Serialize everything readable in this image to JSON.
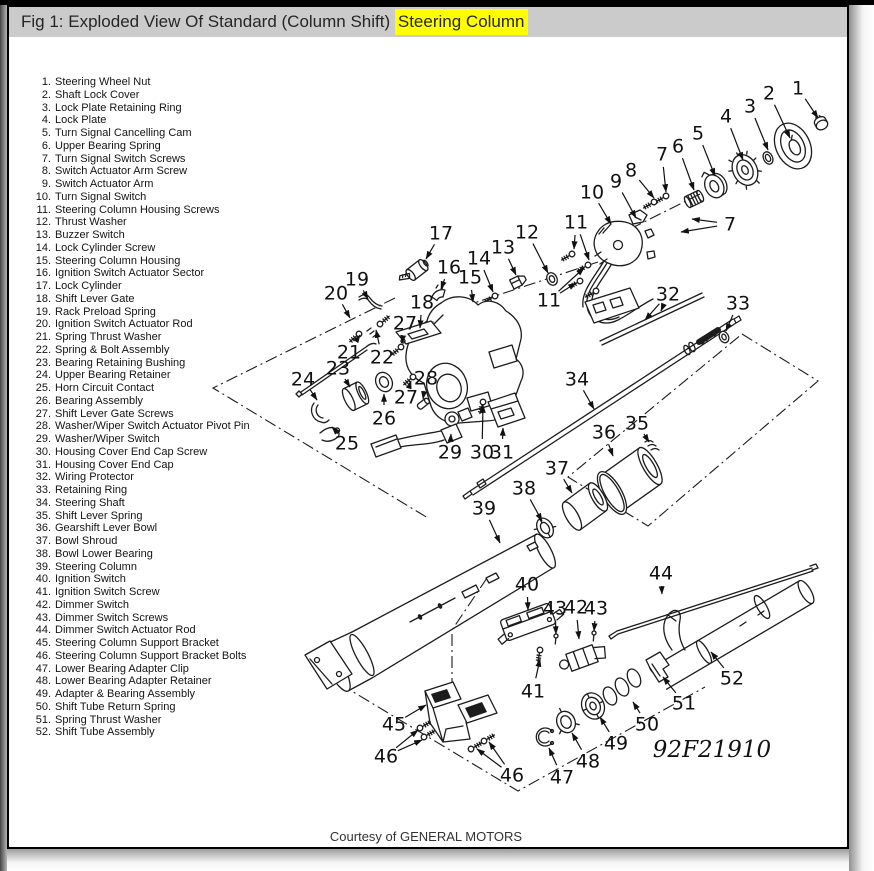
{
  "figure": {
    "title_prefix": "Fig 1: Exploded View Of Standard (Column Shift) ",
    "title_highlight": "Steering Column",
    "highlight_color": "#ffff00",
    "title_bar_bg": "#cbcbcb"
  },
  "footer": {
    "credit": "Courtesy of GENERAL MOTORS"
  },
  "parts_list": {
    "items": [
      {
        "num": "1",
        "name": "Steering Wheel Nut"
      },
      {
        "num": "2",
        "name": "Shaft Lock Cover"
      },
      {
        "num": "3",
        "name": "Lock Plate Retaining Ring"
      },
      {
        "num": "4",
        "name": "Lock Plate"
      },
      {
        "num": "5",
        "name": "Turn Signal Cancelling Cam"
      },
      {
        "num": "6",
        "name": "Upper Bearing Spring"
      },
      {
        "num": "7",
        "name": "Turn Signal Switch Screws"
      },
      {
        "num": "8",
        "name": "Switch Actuator Arm Screw"
      },
      {
        "num": "9",
        "name": "Switch Actuator Arm"
      },
      {
        "num": "10",
        "name": "Turn Signal Switch"
      },
      {
        "num": "11",
        "name": "Steering Column Housing Screws"
      },
      {
        "num": "12",
        "name": "Thrust Washer"
      },
      {
        "num": "13",
        "name": "Buzzer Switch"
      },
      {
        "num": "14",
        "name": "Lock Cylinder Screw"
      },
      {
        "num": "15",
        "name": "Steering Column Housing"
      },
      {
        "num": "16",
        "name": "Ignition Switch Actuator Sector"
      },
      {
        "num": "17",
        "name": "Lock Cylinder"
      },
      {
        "num": "18",
        "name": "Shift Lever Gate"
      },
      {
        "num": "19",
        "name": "Rack Preload Spring"
      },
      {
        "num": "20",
        "name": "Ignition Switch Actuator Rod"
      },
      {
        "num": "21",
        "name": "Spring Thrust Washer"
      },
      {
        "num": "22",
        "name": "Spring & Bolt Assembly"
      },
      {
        "num": "23",
        "name": "Bearing Retaining Bushing"
      },
      {
        "num": "24",
        "name": "Upper Bearing Retainer"
      },
      {
        "num": "25",
        "name": "Horn Circuit Contact"
      },
      {
        "num": "26",
        "name": "Bearing Assembly"
      },
      {
        "num": "27",
        "name": "Shift Lever Gate Screws"
      },
      {
        "num": "28",
        "name": "Washer/Wiper Switch Actuator Pivot Pin"
      },
      {
        "num": "29",
        "name": "Washer/Wiper Switch"
      },
      {
        "num": "30",
        "name": "Housing Cover End Cap Screw"
      },
      {
        "num": "31",
        "name": "Housing Cover End Cap"
      },
      {
        "num": "32",
        "name": "Wiring Protector"
      },
      {
        "num": "33",
        "name": "Retaining Ring"
      },
      {
        "num": "34",
        "name": "Steering Shaft"
      },
      {
        "num": "35",
        "name": "Shift Lever Spring"
      },
      {
        "num": "36",
        "name": "Gearshift Lever Bowl"
      },
      {
        "num": "37",
        "name": "Bowl Shroud"
      },
      {
        "num": "38",
        "name": "Bowl Lower Bearing"
      },
      {
        "num": "39",
        "name": "Steering Column"
      },
      {
        "num": "40",
        "name": "Ignition Switch"
      },
      {
        "num": "41",
        "name": "Ignition Switch Screw"
      },
      {
        "num": "42",
        "name": "Dimmer Switch"
      },
      {
        "num": "43",
        "name": "Dimmer Switch Screws"
      },
      {
        "num": "44",
        "name": "Dimmer Switch Actuator Rod"
      },
      {
        "num": "45",
        "name": "Steering Column Support Bracket"
      },
      {
        "num": "46",
        "name": "Steering Column Support Bracket Bolts"
      },
      {
        "num": "47",
        "name": "Lower Bearing Adapter Clip"
      },
      {
        "num": "48",
        "name": "Lower Bearing Adapter Retainer"
      },
      {
        "num": "49",
        "name": "Adapter & Bearing Assembly"
      },
      {
        "num": "50",
        "name": "Shift Tube Return Spring"
      },
      {
        "num": "51",
        "name": "Spring Thrust Washer"
      },
      {
        "num": "52",
        "name": "Shift Tube Assembly"
      }
    ]
  },
  "diagram": {
    "figure_code": "92F21910",
    "callouts": [
      {
        "label": "1",
        "x": 798,
        "y": 88,
        "tips": [
          [
            818,
            118
          ]
        ]
      },
      {
        "label": "2",
        "x": 769,
        "y": 93,
        "tips": [
          [
            790,
            138
          ]
        ]
      },
      {
        "label": "3",
        "x": 750,
        "y": 106,
        "tips": [
          [
            768,
            150
          ]
        ]
      },
      {
        "label": "4",
        "x": 726,
        "y": 116,
        "tips": [
          [
            743,
            160
          ]
        ]
      },
      {
        "label": "5",
        "x": 698,
        "y": 133,
        "tips": [
          [
            715,
            176
          ]
        ]
      },
      {
        "label": "6",
        "x": 678,
        "y": 146,
        "tips": [
          [
            694,
            190
          ]
        ]
      },
      {
        "label": "7",
        "x": 662,
        "y": 154,
        "tips": [
          [
            666,
            192
          ]
        ]
      },
      {
        "label": "8",
        "x": 631,
        "y": 170,
        "tips": [
          [
            654,
            198
          ]
        ]
      },
      {
        "label": "9",
        "x": 616,
        "y": 181,
        "tips": [
          [
            636,
            218
          ]
        ]
      },
      {
        "label": "10",
        "x": 592,
        "y": 192,
        "tips": [
          [
            611,
            224
          ]
        ]
      },
      {
        "label": "11",
        "x": 576,
        "y": 222,
        "tips": [
          [
            574,
            249
          ],
          [
            589,
            260
          ]
        ]
      },
      {
        "label": "7",
        "x": 730,
        "y": 224,
        "tips": [
          [
            692,
            219
          ],
          [
            681,
            232
          ]
        ]
      },
      {
        "label": "11",
        "x": 549,
        "y": 300,
        "tips": [
          [
            576,
            283
          ],
          [
            584,
            268
          ]
        ]
      },
      {
        "label": "12",
        "x": 527,
        "y": 232,
        "tips": [
          [
            548,
            273
          ]
        ]
      },
      {
        "label": "13",
        "x": 503,
        "y": 247,
        "tips": [
          [
            516,
            275
          ]
        ]
      },
      {
        "label": "14",
        "x": 479,
        "y": 258,
        "tips": [
          [
            493,
            292
          ]
        ]
      },
      {
        "label": "15",
        "x": 470,
        "y": 277,
        "tips": [
          [
            473,
            302
          ]
        ]
      },
      {
        "label": "16",
        "x": 449,
        "y": 267,
        "tips": [
          [
            441,
            289
          ]
        ]
      },
      {
        "label": "17",
        "x": 441,
        "y": 233,
        "tips": [
          [
            426,
            259
          ]
        ]
      },
      {
        "label": "18",
        "x": 422,
        "y": 302,
        "tips": [
          [
            420,
            328
          ]
        ]
      },
      {
        "label": "19",
        "x": 357,
        "y": 279,
        "tips": [
          [
            368,
            299
          ]
        ]
      },
      {
        "label": "20",
        "x": 336,
        "y": 293,
        "tips": [
          [
            350,
            318
          ]
        ]
      },
      {
        "label": "21",
        "x": 349,
        "y": 352,
        "tips": [
          [
            360,
            335
          ]
        ]
      },
      {
        "label": "22",
        "x": 382,
        "y": 357,
        "tips": [
          [
            376,
            330
          ]
        ]
      },
      {
        "label": "23",
        "x": 338,
        "y": 368,
        "tips": [
          [
            350,
            387
          ]
        ]
      },
      {
        "label": "24",
        "x": 303,
        "y": 379,
        "tips": [
          [
            317,
            400
          ]
        ]
      },
      {
        "label": "25",
        "x": 347,
        "y": 443,
        "tips": [
          [
            332,
            427
          ]
        ]
      },
      {
        "label": "26",
        "x": 384,
        "y": 418,
        "tips": [
          [
            384,
            394
          ]
        ]
      },
      {
        "label": "27",
        "x": 405,
        "y": 323,
        "tips": [
          [
            402,
            343
          ]
        ]
      },
      {
        "label": "27",
        "x": 406,
        "y": 397,
        "tips": [
          [
            411,
            381
          ]
        ]
      },
      {
        "label": "28",
        "x": 426,
        "y": 378,
        "tips": [
          [
            423,
            399
          ]
        ]
      },
      {
        "label": "29",
        "x": 450,
        "y": 452,
        "tips": [
          [
            451,
            434
          ]
        ]
      },
      {
        "label": "30",
        "x": 482,
        "y": 452,
        "tips": [
          [
            483,
            405
          ]
        ]
      },
      {
        "label": "31",
        "x": 502,
        "y": 452,
        "tips": [
          [
            503,
            428
          ]
        ]
      },
      {
        "label": "32",
        "x": 668,
        "y": 294,
        "tips": [
          [
            645,
            320
          ],
          [
            661,
            311
          ]
        ]
      },
      {
        "label": "33",
        "x": 738,
        "y": 303,
        "tips": [
          [
            726,
            331
          ]
        ]
      },
      {
        "label": "34",
        "x": 577,
        "y": 379,
        "tips": [
          [
            594,
            409
          ]
        ]
      },
      {
        "label": "35",
        "x": 637,
        "y": 423,
        "tips": [
          [
            649,
            442
          ]
        ]
      },
      {
        "label": "36",
        "x": 604,
        "y": 432,
        "tips": [
          [
            613,
            456
          ]
        ]
      },
      {
        "label": "37",
        "x": 557,
        "y": 468,
        "tips": [
          [
            572,
            493
          ]
        ]
      },
      {
        "label": "38",
        "x": 524,
        "y": 488,
        "tips": [
          [
            542,
            521
          ]
        ]
      },
      {
        "label": "39",
        "x": 484,
        "y": 508,
        "tips": [
          [
            500,
            543
          ]
        ]
      },
      {
        "label": "40",
        "x": 527,
        "y": 584,
        "tips": [
          [
            528,
            610
          ]
        ]
      },
      {
        "label": "41",
        "x": 533,
        "y": 691,
        "tips": [
          [
            540,
            659
          ]
        ]
      },
      {
        "label": "42",
        "x": 576,
        "y": 607,
        "tips": [
          [
            579,
            639
          ]
        ]
      },
      {
        "label": "43",
        "x": 555,
        "y": 608,
        "tips": [
          [
            556,
            634
          ]
        ]
      },
      {
        "label": "43",
        "x": 596,
        "y": 608,
        "tips": [
          [
            594,
            631
          ]
        ]
      },
      {
        "label": "44",
        "x": 661,
        "y": 573,
        "tips": [
          [
            662,
            594
          ]
        ]
      },
      {
        "label": "45",
        "x": 394,
        "y": 724,
        "tips": [
          [
            426,
            705
          ]
        ]
      },
      {
        "label": "46",
        "x": 386,
        "y": 756,
        "tips": [
          [
            418,
            730
          ],
          [
            422,
            740
          ]
        ]
      },
      {
        "label": "46",
        "x": 512,
        "y": 775,
        "tips": [
          [
            477,
            749
          ],
          [
            489,
            742
          ]
        ]
      },
      {
        "label": "47",
        "x": 562,
        "y": 777,
        "tips": [
          [
            549,
            748
          ]
        ]
      },
      {
        "label": "48",
        "x": 588,
        "y": 761,
        "tips": [
          [
            572,
            733
          ]
        ]
      },
      {
        "label": "49",
        "x": 616,
        "y": 743,
        "tips": [
          [
            600,
            717
          ]
        ]
      },
      {
        "label": "50",
        "x": 647,
        "y": 724,
        "tips": [
          [
            633,
            702
          ]
        ]
      },
      {
        "label": "51",
        "x": 684,
        "y": 703,
        "tips": [
          [
            663,
            677
          ]
        ]
      },
      {
        "label": "52",
        "x": 732,
        "y": 678,
        "tips": [
          [
            711,
            652
          ]
        ]
      }
    ]
  }
}
